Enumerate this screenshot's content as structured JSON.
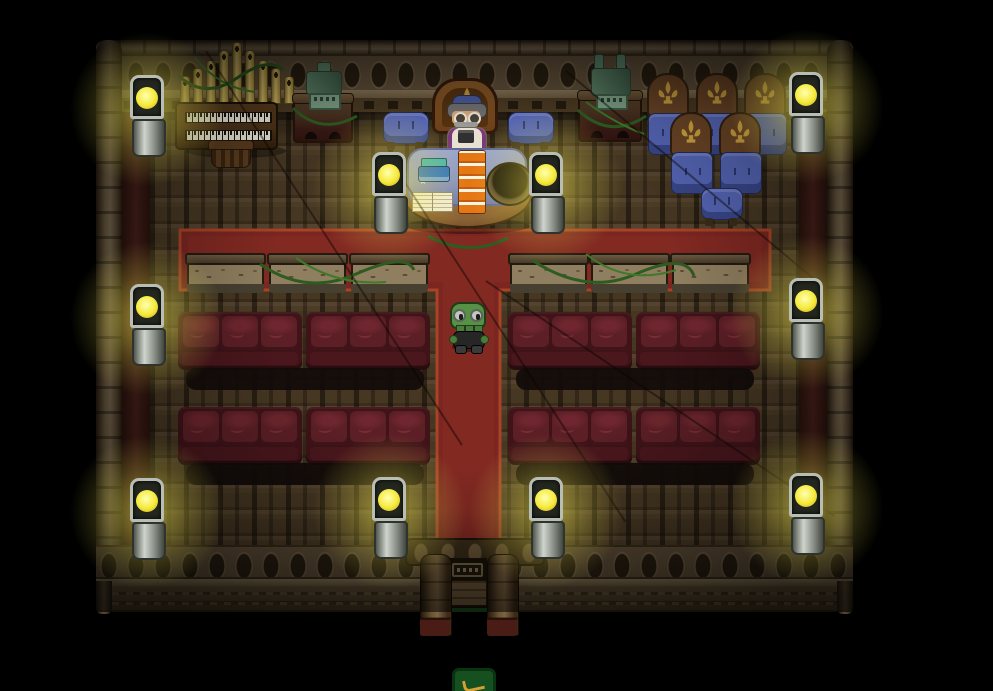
{
  "meta": {
    "title": "Pixel chapel interior scene"
  },
  "colors": {
    "lamp-glow": "#f5e93a",
    "carpet": "#7b2621",
    "carpet-border": "#a84326",
    "pew-body": "#3f1318",
    "pew-cushion": "#5c1f26",
    "bench-stone": "#8f7e5f",
    "chair-wood": "#6b4526",
    "chair-gold": "#d2a53f",
    "chair-blue": "#5565b5",
    "statue-green": "#5d8468",
    "organ-pipe": "#d9c36a",
    "key-white": "#ece8da",
    "cloth-blue": "#8b96c2",
    "table-wood": "#8a6134",
    "book-orange": "#e57614",
    "book-blue": "#2f74c0",
    "page-white": "#f2ecd8",
    "npc-robe": "#e8e0d0",
    "npc-skin": "#d8a878",
    "npc-hair": "#6f6f6f",
    "npc-cap": "#4a5a9e",
    "player-green": "#569146",
    "player-dark": "#262626",
    "door-wood": "#6e583a",
    "pillar-base": "#4a1c16",
    "sign-green": "#175020",
    "sign-gold": "#d8a030"
  },
  "labels": {
    "scene": "Chapel interior",
    "organ": "Pipe organ",
    "organ_stool": "Organ stool",
    "statue_left": "Green gargoyle statue",
    "statue_right": "Green cathedral statue",
    "throne": "Ornate throne",
    "priest": "Elderly priest NPC",
    "altar": "Altar table with books and basin",
    "blue_chair": "Blue cushioned chair",
    "ornate_chair": "Ornate fleur chair",
    "bench": "Stone bench with vines",
    "pew": "Red pew couch",
    "wall_lamp": "Glowing lantern",
    "player": "Player character",
    "door": "Entrance door",
    "door_sign": "Door sign",
    "green_sign": "Green signpost"
  },
  "scene": {
    "objects": [
      "pipe-organ",
      "organ-stool",
      "gargoyle-statue",
      "cathedral-statue",
      "throne",
      "priest-npc",
      "altar-table",
      "blue-chairs",
      "ornate-chairs",
      "stone-benches",
      "red-pews",
      "wall-lanterns",
      "standing-lanterns",
      "player-character",
      "entrance-door",
      "green-signpost",
      "red-t-carpet"
    ]
  }
}
